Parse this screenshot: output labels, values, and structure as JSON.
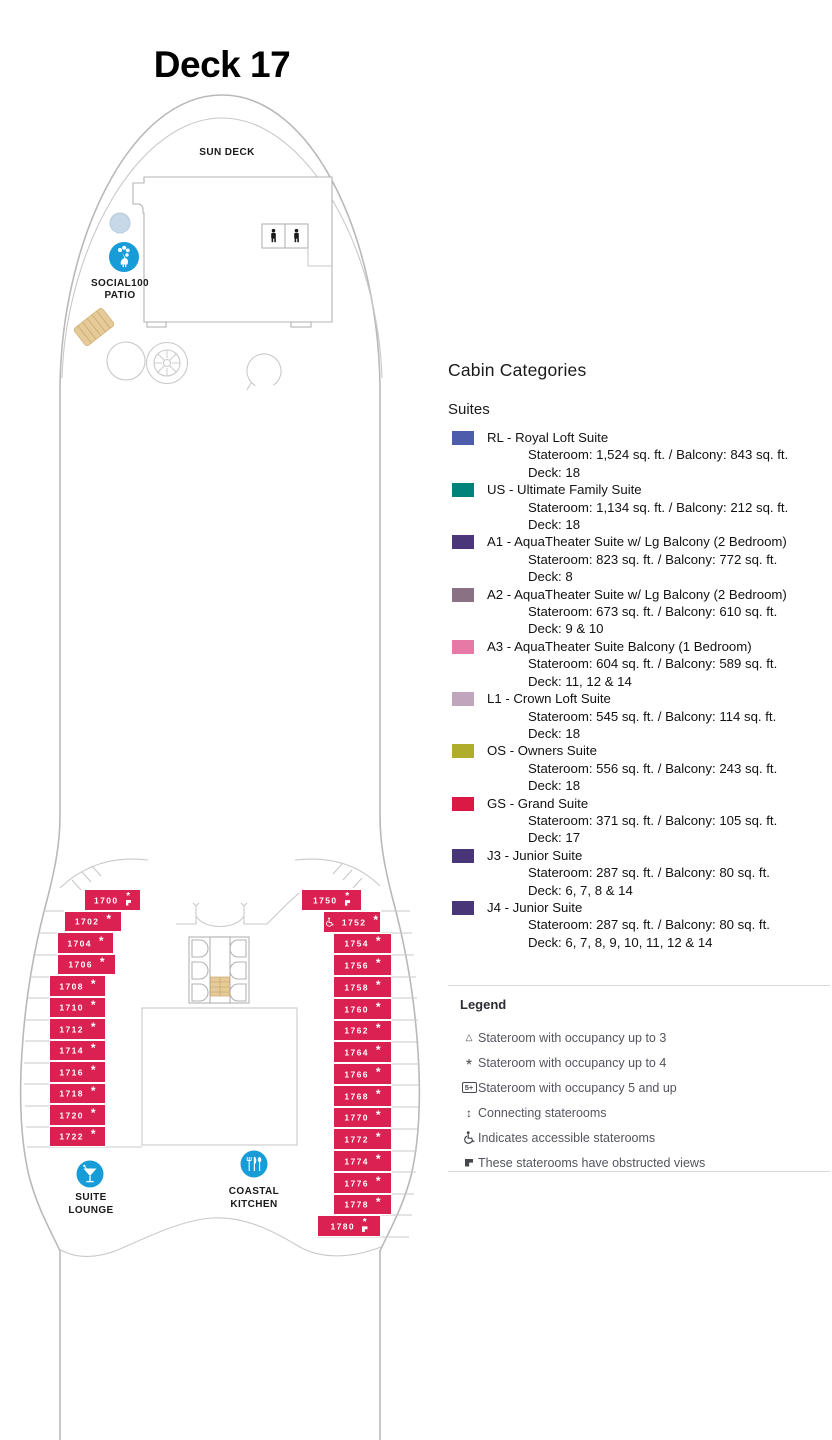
{
  "page": {
    "title": "Deck 17"
  },
  "ship": {
    "cabin_color": "#db2052",
    "icon_blue": "#189cd8",
    "labels": {
      "sun_deck": "SUN DECK",
      "social100": "SOCIAL100",
      "patio": "PATIO",
      "suite": "SUITE",
      "lounge": "LOUNGE",
      "coastal": "COASTAL",
      "kitchen": "KITCHEN"
    },
    "cabins_left": [
      {
        "num": "1700",
        "sym": [
          "occ4",
          "obstructed"
        ]
      },
      {
        "num": "1702",
        "sym": [
          "occ4"
        ]
      },
      {
        "num": "1704",
        "sym": [
          "occ4"
        ]
      },
      {
        "num": "1706",
        "sym": [
          "occ4"
        ]
      },
      {
        "num": "1708",
        "sym": [
          "occ4"
        ]
      },
      {
        "num": "1710",
        "sym": [
          "occ4"
        ]
      },
      {
        "num": "1712",
        "sym": [
          "occ4"
        ]
      },
      {
        "num": "1714",
        "sym": [
          "occ4"
        ]
      },
      {
        "num": "1716",
        "sym": [
          "occ4"
        ]
      },
      {
        "num": "1718",
        "sym": [
          "occ4"
        ]
      },
      {
        "num": "1720",
        "sym": [
          "occ4"
        ]
      },
      {
        "num": "1722",
        "sym": [
          "occ4"
        ]
      }
    ],
    "cabins_right": [
      {
        "num": "1750",
        "sym": [
          "occ4",
          "obstructed"
        ]
      },
      {
        "num": "1752",
        "sym": [
          "accessible",
          "occ4"
        ]
      },
      {
        "num": "1754",
        "sym": [
          "occ4"
        ]
      },
      {
        "num": "1756",
        "sym": [
          "occ4"
        ]
      },
      {
        "num": "1758",
        "sym": [
          "occ4"
        ]
      },
      {
        "num": "1760",
        "sym": [
          "occ4"
        ]
      },
      {
        "num": "1762",
        "sym": [
          "occ4"
        ]
      },
      {
        "num": "1764",
        "sym": [
          "occ4"
        ]
      },
      {
        "num": "1766",
        "sym": [
          "occ4"
        ]
      },
      {
        "num": "1768",
        "sym": [
          "occ4"
        ]
      },
      {
        "num": "1770",
        "sym": [
          "occ4"
        ]
      },
      {
        "num": "1772",
        "sym": [
          "occ4"
        ]
      },
      {
        "num": "1774",
        "sym": [
          "occ4"
        ]
      },
      {
        "num": "1776",
        "sym": [
          "occ4"
        ]
      },
      {
        "num": "1778",
        "sym": [
          "occ4"
        ]
      },
      {
        "num": "1780",
        "sym": [
          "occ4",
          "obstructed"
        ]
      }
    ]
  },
  "categories": {
    "heading": "Cabin Categories",
    "group": "Suites",
    "items": [
      {
        "label": "RL - Royal Loft Suite",
        "color": "#4d5dab",
        "size": "Stateroom: 1,524 sq. ft. / Balcony: 843 sq. ft.",
        "deck": "Deck: 18"
      },
      {
        "label": "US - Ultimate Family Suite",
        "color": "#00837b",
        "size": "Stateroom: 1,134 sq. ft. / Balcony: 212 sq. ft.",
        "deck": "Deck: 18"
      },
      {
        "label": "A1 - AquaTheater Suite w/ Lg Balcony (2 Bedroom)",
        "color": "#4a3679",
        "size": "Stateroom: 823 sq. ft. / Balcony: 772 sq. ft.",
        "deck": "Deck: 8"
      },
      {
        "label": "A2 - AquaTheater Suite w/ Lg Balcony (2 Bedroom)",
        "color": "#8a7184",
        "size": "Stateroom: 673 sq. ft. / Balcony: 610 sq. ft.",
        "deck": "Deck: 9 & 10"
      },
      {
        "label": "A3 - AquaTheater Suite Balcony (1 Bedroom)",
        "color": "#e679a5",
        "size": "Stateroom: 604 sq. ft. / Balcony: 589 sq. ft.",
        "deck": "Deck: 11, 12 & 14"
      },
      {
        "label": "L1 - Crown Loft Suite",
        "color": "#c0a5bd",
        "size": "Stateroom: 545 sq. ft. / Balcony: 114 sq. ft.",
        "deck": "Deck: 18"
      },
      {
        "label": "OS - Owners Suite",
        "color": "#b0ad2d",
        "size": "Stateroom: 556 sq. ft. / Balcony: 243 sq. ft.",
        "deck": "Deck: 18"
      },
      {
        "label": "GS - Grand Suite",
        "color": "#db1945",
        "size": "Stateroom: 371 sq. ft. / Balcony: 105 sq. ft.",
        "deck": "Deck: 17"
      },
      {
        "label": "J3 - Junior Suite",
        "color": "#493679",
        "size": "Stateroom: 287 sq. ft. / Balcony: 80 sq. ft.",
        "deck": "Deck: 6, 7, 8 & 14"
      },
      {
        "label": "J4 - Junior Suite",
        "color": "#493679",
        "size": "Stateroom: 287 sq. ft. / Balcony: 80 sq. ft.",
        "deck": "Deck: 6, 7, 8, 9, 10, 11, 12 & 14"
      }
    ]
  },
  "legend": {
    "heading": "Legend",
    "items": [
      {
        "icon": "occ3",
        "text": "Stateroom with occupancy up to 3"
      },
      {
        "icon": "occ4",
        "text": "Stateroom with occupancy up to 4"
      },
      {
        "icon": "occ5",
        "text": "Stateroom with occupancy 5 and up"
      },
      {
        "icon": "connecting",
        "text": "Connecting staterooms"
      },
      {
        "icon": "accessible",
        "text": "Indicates accessible staterooms"
      },
      {
        "icon": "obstructed",
        "text": "These staterooms have obstructed views"
      }
    ],
    "occ5_label": "5+"
  }
}
